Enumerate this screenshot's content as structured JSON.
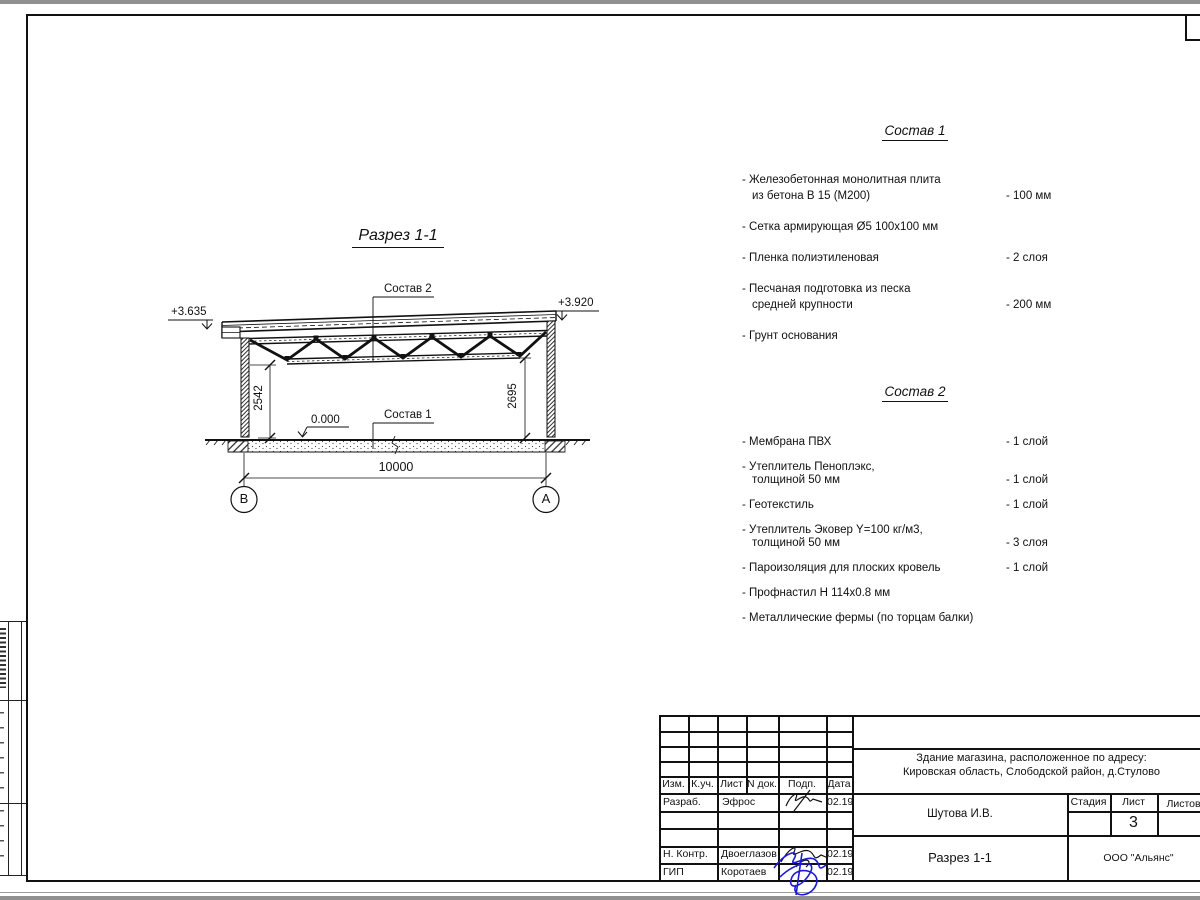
{
  "drawing": {
    "title": "Разрез 1-1",
    "elevation_left": "+3.635",
    "elevation_right": "+3.920",
    "roof_label": "Состав 2",
    "floor_label": "Состав 1",
    "zero_level": "0.000",
    "height_left": "2542",
    "height_right": "2695",
    "span": "10000",
    "axis_left": "В",
    "axis_right": "А"
  },
  "composition1": {
    "title": "Состав 1",
    "items": [
      {
        "lines": [
          "- Железобетонная  монолитная плита",
          "из бетона В 15 (М200)"
        ],
        "value": "- 100 мм"
      },
      {
        "lines": [
          "- Сетка армирующая Ø5 100х100 мм"
        ],
        "value": ""
      },
      {
        "lines": [
          "- Пленка полиэтиленовая"
        ],
        "value": "-  2 слоя"
      },
      {
        "lines": [
          "- Песчаная подготовка из песка",
          "средней крупности"
        ],
        "value": "- 200 мм"
      },
      {
        "lines": [
          "- Грунт основания"
        ],
        "value": ""
      }
    ]
  },
  "composition2": {
    "title": "Состав 2",
    "items": [
      {
        "lines": [
          "- Мембрана ПВХ"
        ],
        "value": "- 1 слой"
      },
      {
        "lines": [
          "- Утеплитель Пеноплэкс,",
          "толщиной 50 мм"
        ],
        "value": "- 1 слой"
      },
      {
        "lines": [
          "- Геотекстиль"
        ],
        "value": "- 1 слой"
      },
      {
        "lines": [
          "- Утеплитель Эковер Y=100 кг/м3,",
          "толщиной 50 мм"
        ],
        "value": "- 3 слоя"
      },
      {
        "lines": [
          "- Пароизоляция для плоских кровель"
        ],
        "value": "- 1 слой"
      },
      {
        "lines": [
          "- Профнастил Н 114х0.8 мм"
        ],
        "value": ""
      },
      {
        "lines": [
          "- Металлические фермы (по торцам балки)"
        ],
        "value": ""
      }
    ]
  },
  "titleblock": {
    "rev_header": [
      "Изм.",
      "К.уч.",
      "Лист",
      "N док.",
      "Подп.",
      "Дата"
    ],
    "signatures": [
      {
        "label": "Разраб.",
        "name": "Эфрос",
        "date": "02.19"
      },
      {
        "label": "Н. Контр.",
        "name": "Двоеглазов",
        "date": "02.19"
      },
      {
        "label": "ГИП",
        "name": "Коротаев",
        "date": "02.19"
      }
    ],
    "project_line1": "Здание магазина, расположенное по адресу:",
    "project_line2": "Кировская область, Слободской район, д.Стулово",
    "author": "Шутова И.В.",
    "stage_label": "Стадия",
    "sheet_label": "Лист",
    "sheets_label": "Листов",
    "sheet_number": "3",
    "doc_title": "Разрез 1-1",
    "company": "ООО \"Альянс\""
  }
}
